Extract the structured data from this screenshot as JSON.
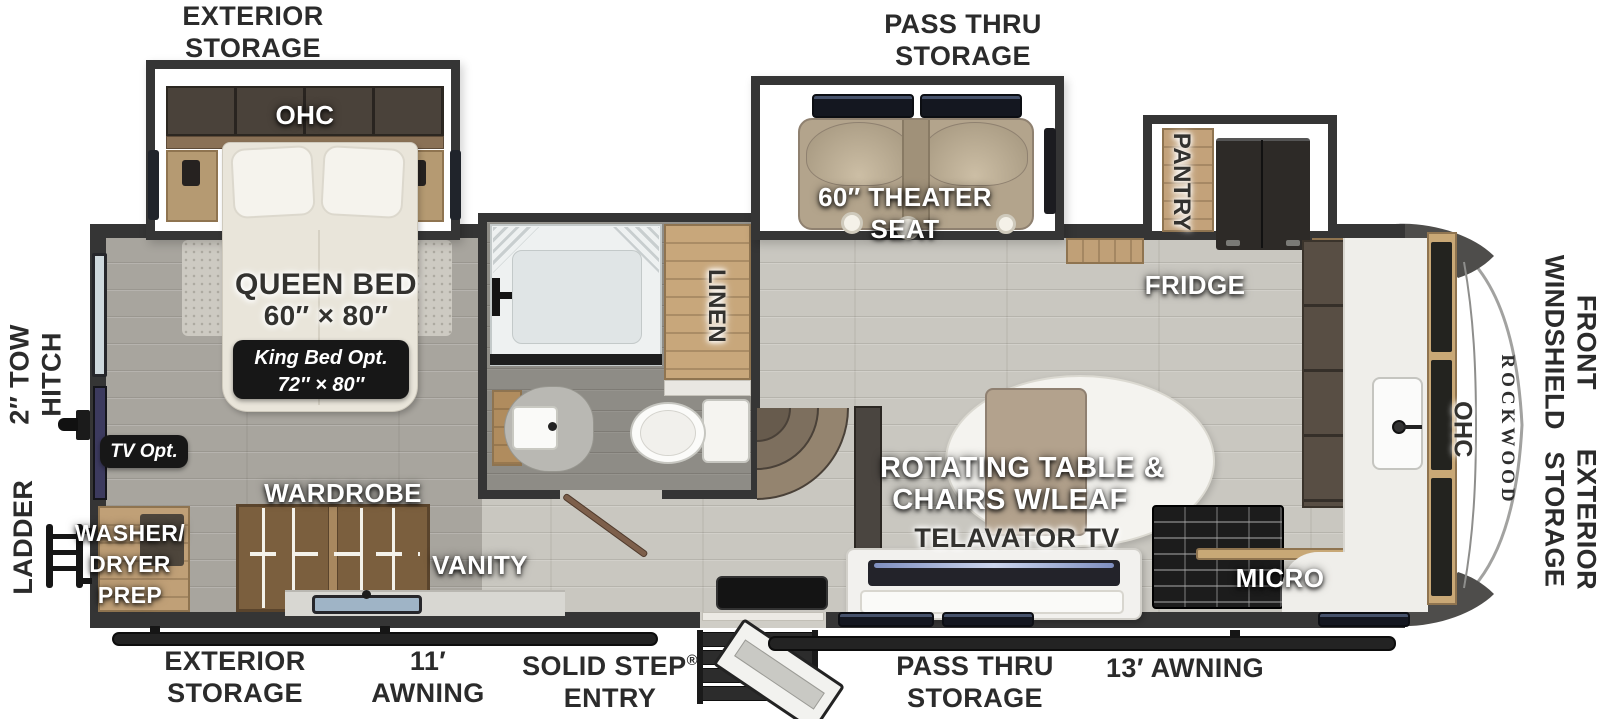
{
  "title": "Rockwood Fifth Wheel Floorplan",
  "brand": "ROCKWOOD",
  "colors": {
    "wall": "#353535",
    "floor_living": "#c9c7c0",
    "floor_bedroom": "#a8a59e",
    "floor_bath": "#8e8c86",
    "wood": "#c0a077",
    "badge_bg": "#171717",
    "seat_tan": "#b3a48c",
    "label_dark": "#2b2b2b"
  },
  "exterior_labels": {
    "top_exterior_storage": {
      "line1": "EXTERIOR",
      "line2": "STORAGE"
    },
    "top_pass_thru": {
      "line1": "PASS THRU",
      "line2": "STORAGE"
    },
    "left_tow_hitch": {
      "line1": "2″ TOW",
      "line2": "HITCH"
    },
    "left_ladder": "LADDER",
    "right_front_windshield": {
      "line1": "FRONT",
      "line2": "WINDSHIELD"
    },
    "right_exterior_storage": {
      "line1": "EXTERIOR",
      "line2": "STORAGE"
    },
    "bottom_exterior_storage": {
      "line1": "EXTERIOR",
      "line2": "STORAGE"
    },
    "bottom_awning_11": {
      "line1": "11′",
      "line2": "AWNING"
    },
    "bottom_solid_step": {
      "line1": "SOLID STEP",
      "reg": "®",
      "line2": "ENTRY"
    },
    "bottom_pass_thru": {
      "line1": "PASS THRU",
      "line2": "STORAGE"
    },
    "bottom_awning_13": "13′ AWNING"
  },
  "bedroom": {
    "ohc": "OHC",
    "bed_title": "QUEEN BED",
    "bed_size": "60″ × 80″",
    "king_line1": "King Bed Opt.",
    "king_line2": "72″ × 80″",
    "tv_opt": "TV Opt.",
    "wardrobe": "WARDROBE",
    "washer_line1": "WASHER/",
    "washer_line2": "DRYER",
    "washer_line3": "PREP"
  },
  "bath": {
    "linen": "LINEN",
    "vanity": "VANITY"
  },
  "living": {
    "theater_line1": "60″ THEATER",
    "theater_line2": "SEAT",
    "pantry": "PANTRY",
    "fridge": "FRIDGE",
    "table_line1": "ROTATING TABLE &",
    "table_line2": "CHAIRS W/LEAF",
    "tv": "TELAVATOR TV",
    "micro": "MICRO",
    "kitchen_ohc": "OHC"
  }
}
